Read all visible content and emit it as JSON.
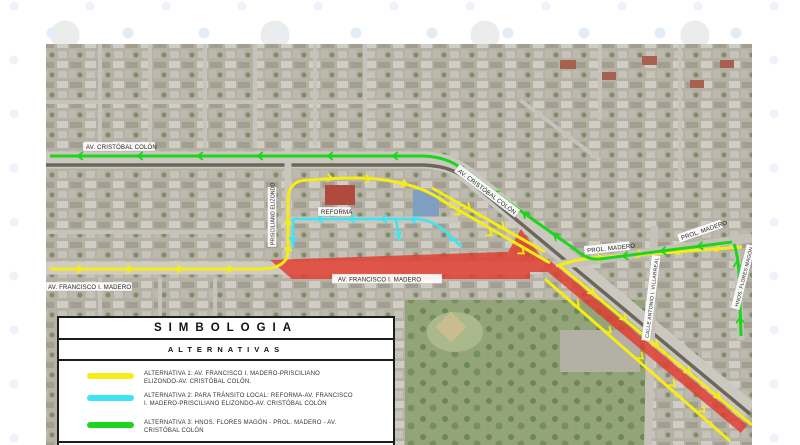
{
  "legend": {
    "title": "SIMBOLOGIA",
    "subtitle": "ALTERNATIVAS",
    "items": [
      {
        "color": "#f7ec13",
        "label": "ALTERNATIVA 1: AV. FRANCISCO I. MADERO-PRISCILIANO ELIZONDO-AV. CRISTÓBAL COLÓN."
      },
      {
        "color": "#3fe4f2",
        "label": "ALTERNATIVA 2: PARA TRÁNSITO LOCAL: REFORMA-AV. FRANCISCO I. MADERO-PRISCILIANO ELIZONDO-AV. CRISTÓBAL COLÓN"
      },
      {
        "color": "#1ed51e",
        "label": "ALTERNATIVA 3: HNOS. FLORES MAGÓN - PROL. MADERO - AV. CRISTÓBAL COLÓN"
      }
    ]
  },
  "map": {
    "closure_color": "#e23b2e",
    "street_labels": {
      "av_cristobal_colon": "AV. CRISTÓBAL COLÓN",
      "av_francisco_i_madero_west": "AV. FRANCISCO I. MADERO",
      "av_francisco_i_madero_closed": "AV. FRANCISCO I. MADERO",
      "prisciliano_elizondo": "PRISCILIANO ELIZONDO",
      "reforma": "REFORMA",
      "av_cristobal_colon_diagonal": "AV. CRISTÓBAL COLÓN",
      "prol_madero_west": "PROL. MADERO",
      "prol_madero_east": "PROL. MADERO",
      "calle_antonio_i_villarreal": "CALLE ANTONIO I. VILLARREAL",
      "hnos_flores_magon": "HNOS. FLORES MAGÓN"
    }
  }
}
